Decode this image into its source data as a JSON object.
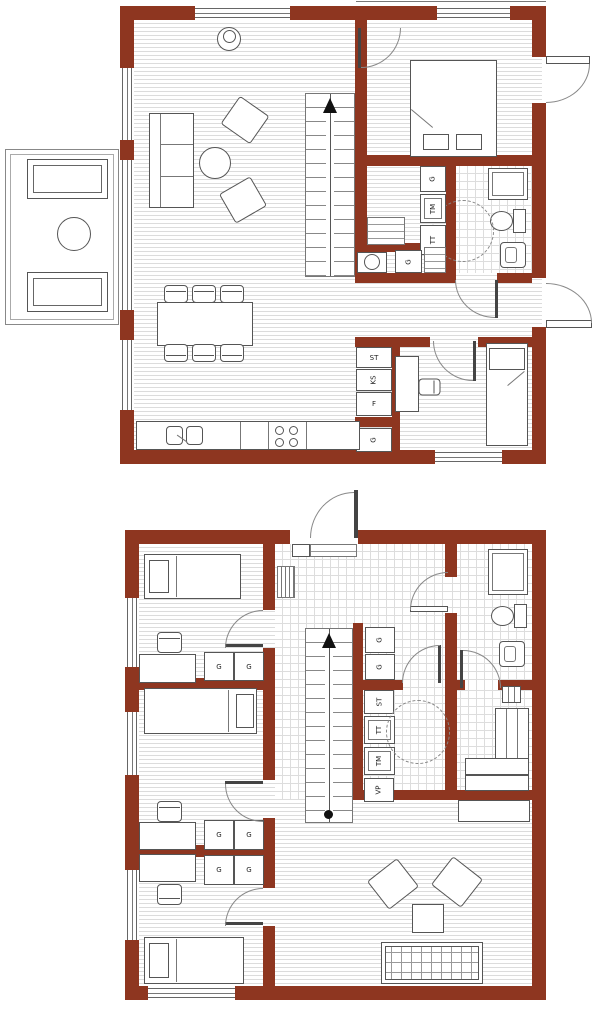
{
  "colors": {
    "wall": "#8e3620",
    "furniture_line": "#4d4d4d",
    "plank_line": "#dcdcdc",
    "tile_line": "#dddddd"
  },
  "floor1": {
    "bath_column": [
      "G",
      "TM",
      "TT"
    ],
    "hall_closet": "G",
    "storage_column": [
      "ST",
      "KS",
      "F"
    ],
    "kitchen_closet": "G"
  },
  "floor2": {
    "hall_wardrobes": [
      "G",
      "G"
    ],
    "utility_column": [
      "ST",
      "TT",
      "TM",
      "VP"
    ],
    "bedroom_a_wardrobes": [
      "G",
      "G"
    ],
    "bedroom_b_wardrobes": [
      "G",
      "G"
    ],
    "bedroom_c_wardrobes": [
      "G",
      "G"
    ]
  }
}
